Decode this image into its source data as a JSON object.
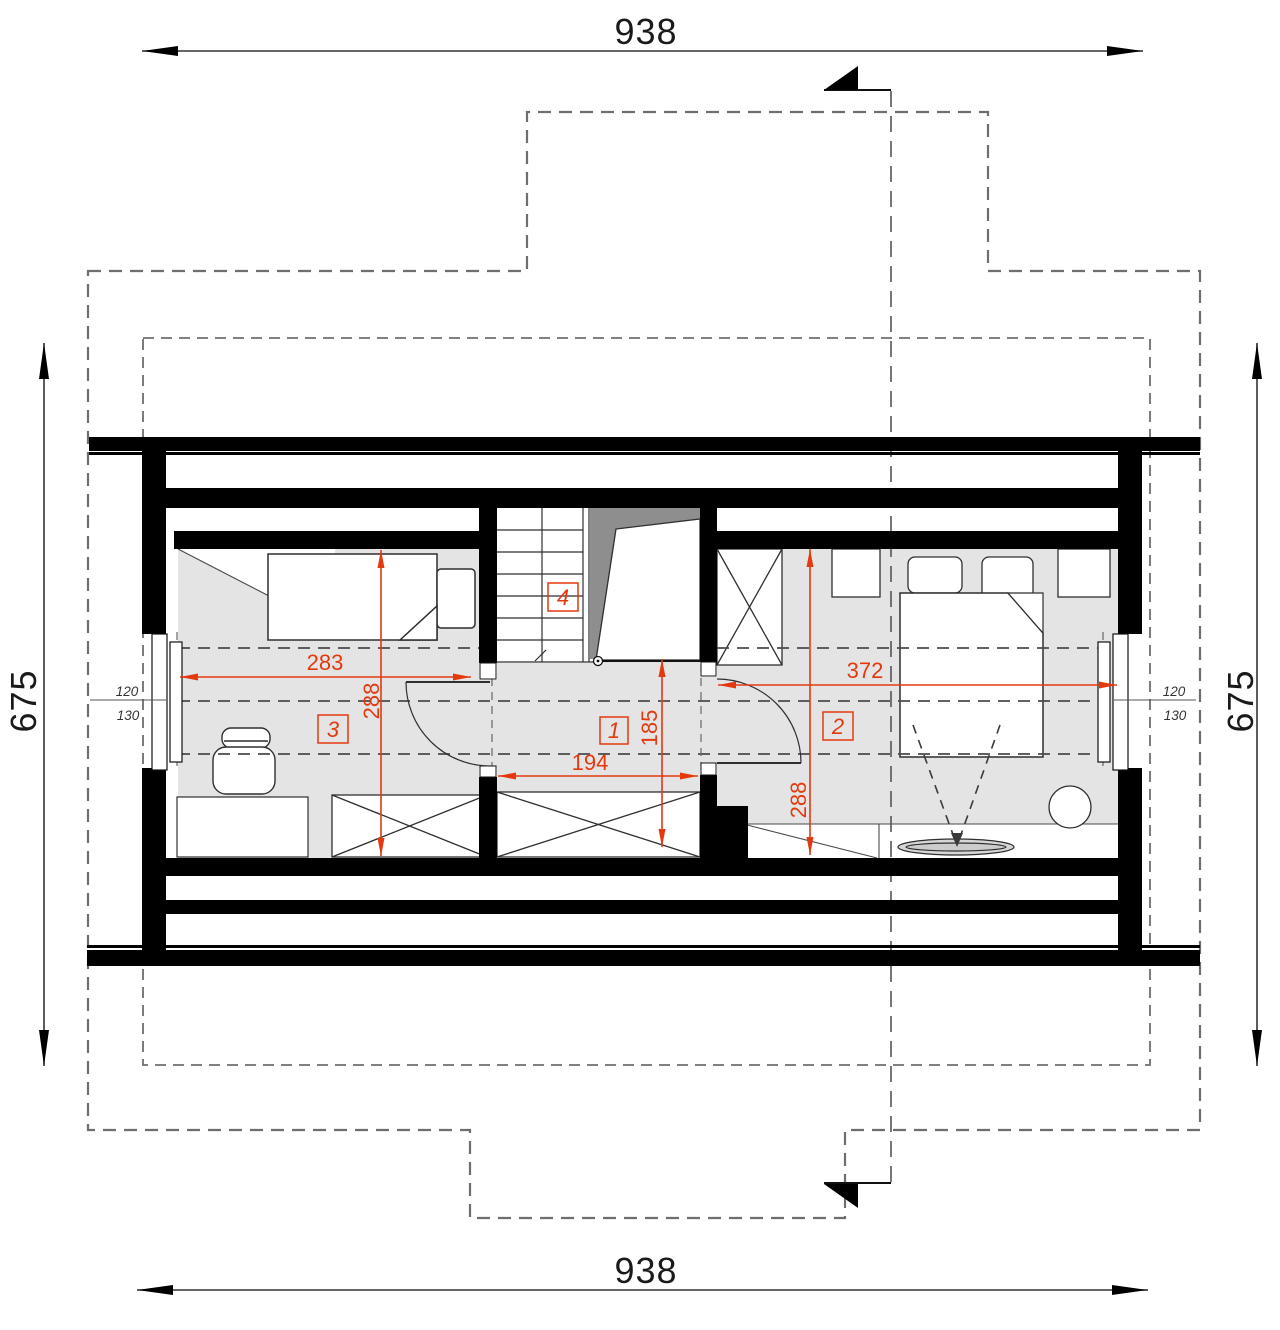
{
  "dimensions": {
    "top": "938",
    "bottom": "938",
    "left": "675",
    "right": "675"
  },
  "rooms": {
    "hall": {
      "label": "1",
      "width": "194",
      "depth": "185"
    },
    "bedroom_right": {
      "label": "2",
      "width": "372",
      "depth": "288"
    },
    "bedroom_left": {
      "label": "3",
      "width": "283",
      "depth": "288"
    },
    "stairs": {
      "label": "4"
    }
  },
  "height_marks": {
    "left": {
      "upper": "120",
      "lower": "130"
    },
    "right": {
      "upper": "120",
      "lower": "130"
    }
  },
  "colors": {
    "dimension_red": "#e4390f",
    "wall_black": "#000000",
    "floor_gray": "#e4e4e4",
    "void_gray": "#8e8e8e",
    "outline_gray": "#6e6e6e"
  }
}
